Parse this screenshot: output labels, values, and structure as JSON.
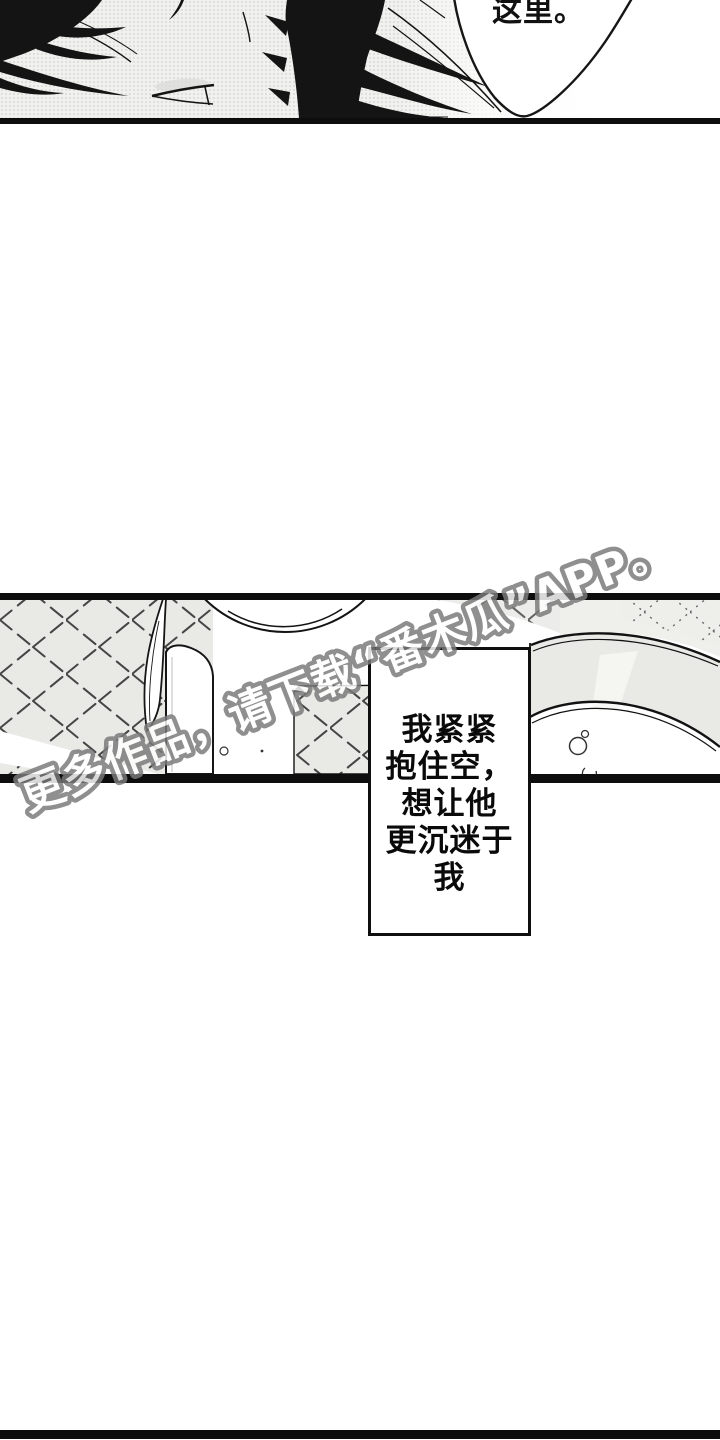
{
  "page": {
    "width": 720,
    "height": 1440,
    "background": "#ffffff"
  },
  "top_panel": {
    "speech_bubble": {
      "text": "这里。"
    }
  },
  "narration_box": {
    "lines": [
      "我紧紧",
      "抱住空，",
      "想让他",
      "更沉迷于",
      "我"
    ]
  },
  "watermark": {
    "text": "更多作品，请下载“番木瓜”APP。"
  },
  "colors": {
    "ink": "#141414",
    "paper_halftone": "#f1f1ef",
    "tile_gray": "#e9e9e6",
    "panel_border": "#0d0d0d",
    "watermark_stroke": "#7a7a7a",
    "watermark_fill": "#ffffff"
  }
}
